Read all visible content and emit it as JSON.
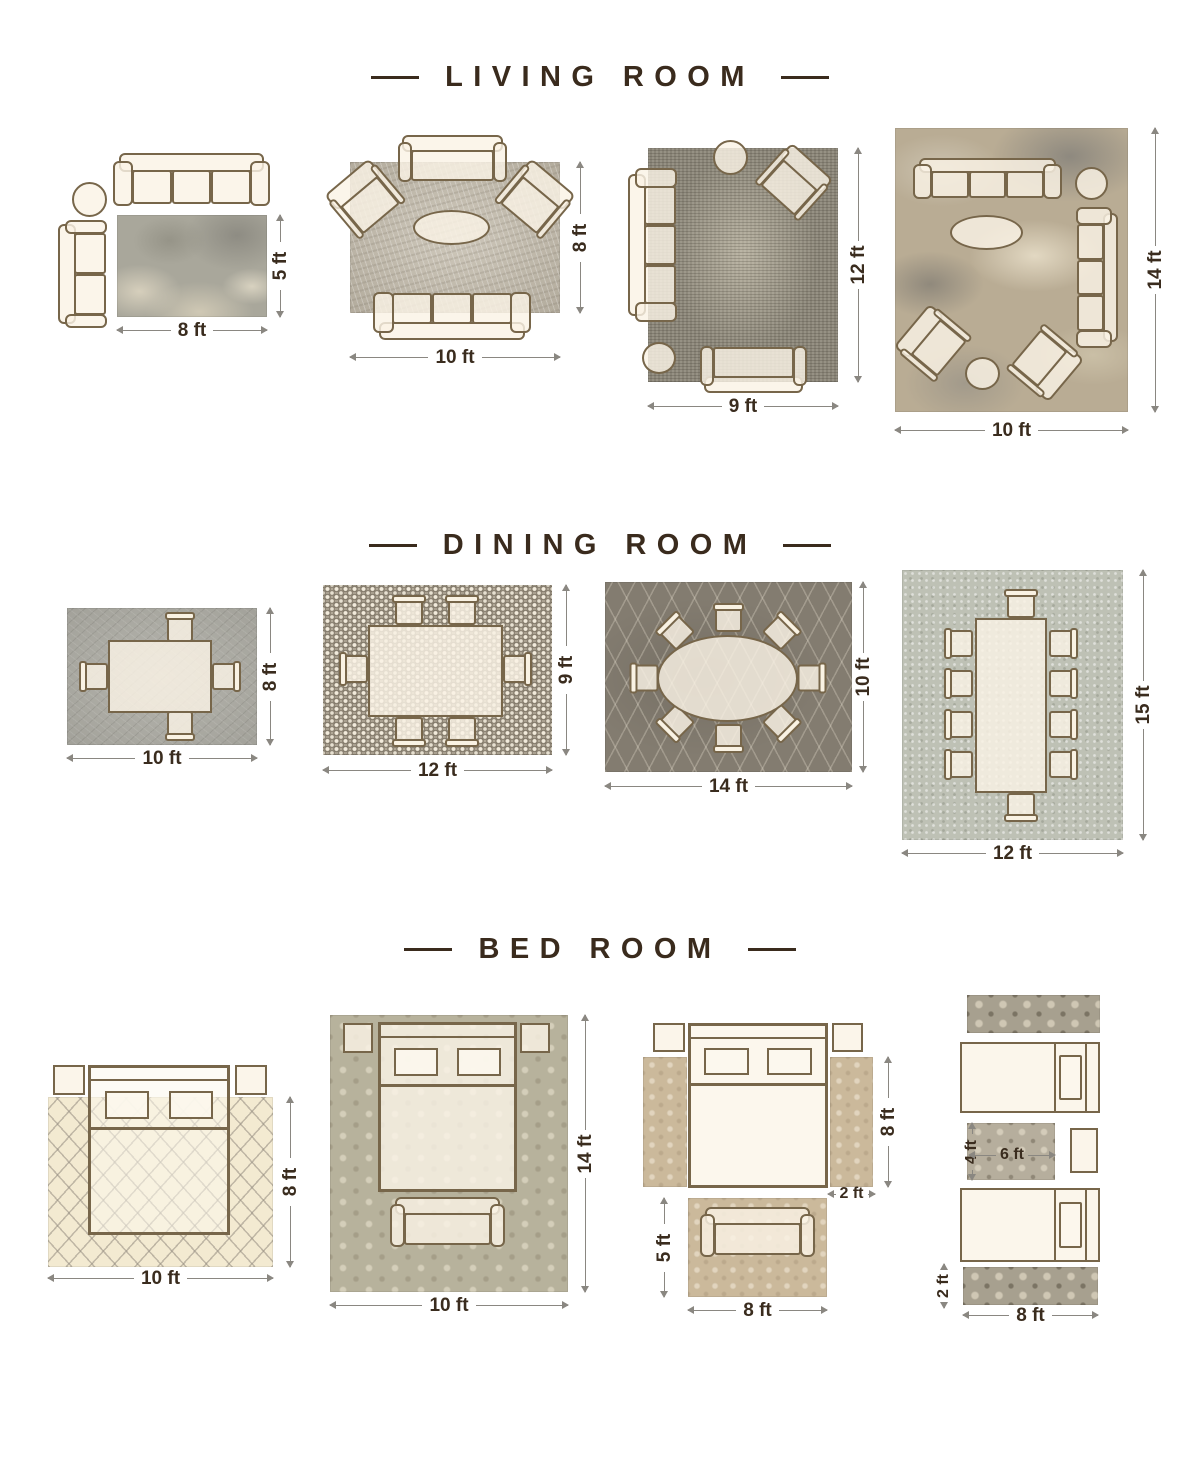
{
  "colors": {
    "text": "#3a2b1d",
    "furniture_outline": "#77664a",
    "furniture_fill": "#f8f1e2",
    "dim_line": "#8a8781"
  },
  "sections": [
    {
      "title": "LIVING ROOM",
      "layouts": [
        {
          "id": "living-1",
          "furniture": [
            "sofa-3-seat",
            "round-side-table",
            "loveseat",
            "abstract-gray-rug"
          ],
          "dim_bottom": "8 ft",
          "dim_right": "5 ft"
        },
        {
          "id": "living-2",
          "furniture": [
            "loveseat",
            "armchair",
            "armchair",
            "oval-coffee-table",
            "sofa-3-seat",
            "textured-beige-rug"
          ],
          "dim_bottom": "10 ft",
          "dim_right": "8 ft"
        },
        {
          "id": "living-3",
          "furniture": [
            "sofa-3-seat",
            "round-side-table",
            "armchair",
            "round-side-table",
            "loveseat",
            "distressed-gray-rug"
          ],
          "dim_bottom": "9 ft",
          "dim_right": "12 ft"
        },
        {
          "id": "living-4",
          "furniture": [
            "sofa-3-seat",
            "round-side-table",
            "sofa-3-seat",
            "oval-coffee-table",
            "armchair",
            "armchair",
            "round-side-table",
            "abstract-tan-rug"
          ],
          "dim_bottom": "10 ft",
          "dim_right": "14 ft"
        }
      ]
    },
    {
      "title": "DINING ROOM",
      "layouts": [
        {
          "id": "dining-1",
          "furniture": [
            "dining-table",
            "chair-x4",
            "gray-textured-rug"
          ],
          "dim_bottom": "10 ft",
          "dim_right": "8 ft"
        },
        {
          "id": "dining-2",
          "furniture": [
            "dining-table",
            "chair-x6",
            "mosaic-rug"
          ],
          "dim_bottom": "12 ft",
          "dim_right": "9 ft"
        },
        {
          "id": "dining-3",
          "furniture": [
            "oval-dining-table",
            "chair-x8",
            "dark-trellis-rug"
          ],
          "dim_bottom": "14 ft",
          "dim_right": "10 ft"
        },
        {
          "id": "dining-4",
          "furniture": [
            "dining-table",
            "chair-x10",
            "light-speckled-rug"
          ],
          "dim_bottom": "12 ft",
          "dim_right": "15 ft"
        }
      ]
    },
    {
      "title": "BED ROOM",
      "layouts": [
        {
          "id": "bedroom-1",
          "furniture": [
            "nightstand",
            "queen-bed",
            "nightstand",
            "cream-lattice-rug"
          ],
          "dim_bottom": "10 ft",
          "dim_right": "8 ft"
        },
        {
          "id": "bedroom-2",
          "furniture": [
            "nightstand",
            "queen-bed",
            "nightstand",
            "bench",
            "damask-beige-rug"
          ],
          "dim_bottom": "10 ft",
          "dim_right": "14 ft"
        },
        {
          "id": "bedroom-3",
          "furniture": [
            "nightstand",
            "queen-bed",
            "nightstand",
            "runner-rug",
            "runner-rug",
            "bench",
            "accent-rug"
          ],
          "dim_right": "8 ft",
          "dim_runner_width": "2 ft",
          "dim_rug_height": "5 ft",
          "dim_rug_width": "8 ft"
        },
        {
          "id": "bedroom-4",
          "furniture": [
            "runner-rug",
            "twin-bed",
            "accent-rug",
            "nightstand",
            "twin-bed",
            "runner-rug"
          ],
          "dim_rug_height": "4 ft",
          "dim_rug_width": "6 ft",
          "dim_runner_height": "2 ft",
          "dim_runner_width": "8 ft"
        }
      ]
    }
  ]
}
